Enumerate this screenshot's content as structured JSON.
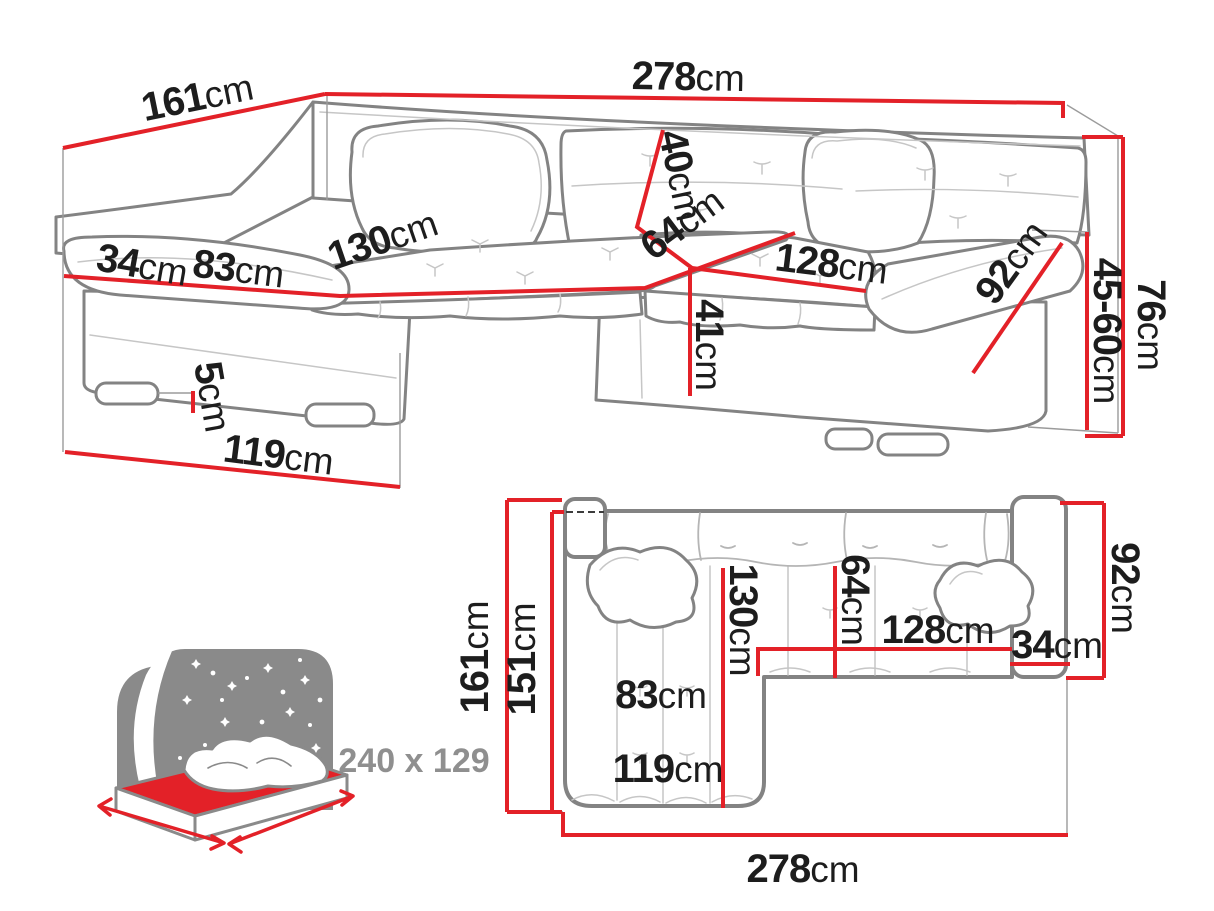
{
  "colors": {
    "dimension_red": "#e32128",
    "outline_gray": "#838383",
    "detail_gray": "#c6c6c6",
    "label_black": "#1d1d1d",
    "icon_gray": "#8a8a8a",
    "icon_text_gray": "#8f8f8f"
  },
  "perspective": {
    "width": {
      "v": "278",
      "u": "cm"
    },
    "depth": {
      "v": "161",
      "u": "cm"
    },
    "backrest_height": {
      "v": "40",
      "u": "cm"
    },
    "seat_depth": {
      "v": "64",
      "u": "cm"
    },
    "seat_width": {
      "v": "128",
      "u": "cm"
    },
    "armrest_length": {
      "v": "92",
      "u": "cm"
    },
    "total_height": {
      "v": "76",
      "u": "cm"
    },
    "headrest_height": {
      "v": "45-60",
      "u": "cm"
    },
    "armrest_width": {
      "v": "34",
      "u": "cm"
    },
    "chaise_seat_width": {
      "v": "83",
      "u": "cm"
    },
    "chaise_length": {
      "v": "130",
      "u": "cm"
    },
    "seat_height": {
      "v": "41",
      "u": "cm"
    },
    "leg_height": {
      "v": "5",
      "u": "cm"
    },
    "chaise_width": {
      "v": "119",
      "u": "cm"
    }
  },
  "plan": {
    "depth": {
      "v": "161",
      "u": "cm"
    },
    "bed_depth": {
      "v": "151",
      "u": "cm"
    },
    "chaise_length": {
      "v": "130",
      "u": "cm"
    },
    "seat_depth": {
      "v": "64",
      "u": "cm"
    },
    "seat_width": {
      "v": "128",
      "u": "cm"
    },
    "armrest_width": {
      "v": "34",
      "u": "cm"
    },
    "armrest_length": {
      "v": "92",
      "u": "cm"
    },
    "chaise_seat_width": {
      "v": "83",
      "u": "cm"
    },
    "chaise_width": {
      "v": "119",
      "u": "cm"
    },
    "width": {
      "v": "278",
      "u": "cm"
    }
  },
  "sleeping": {
    "size": "240 x 129"
  }
}
